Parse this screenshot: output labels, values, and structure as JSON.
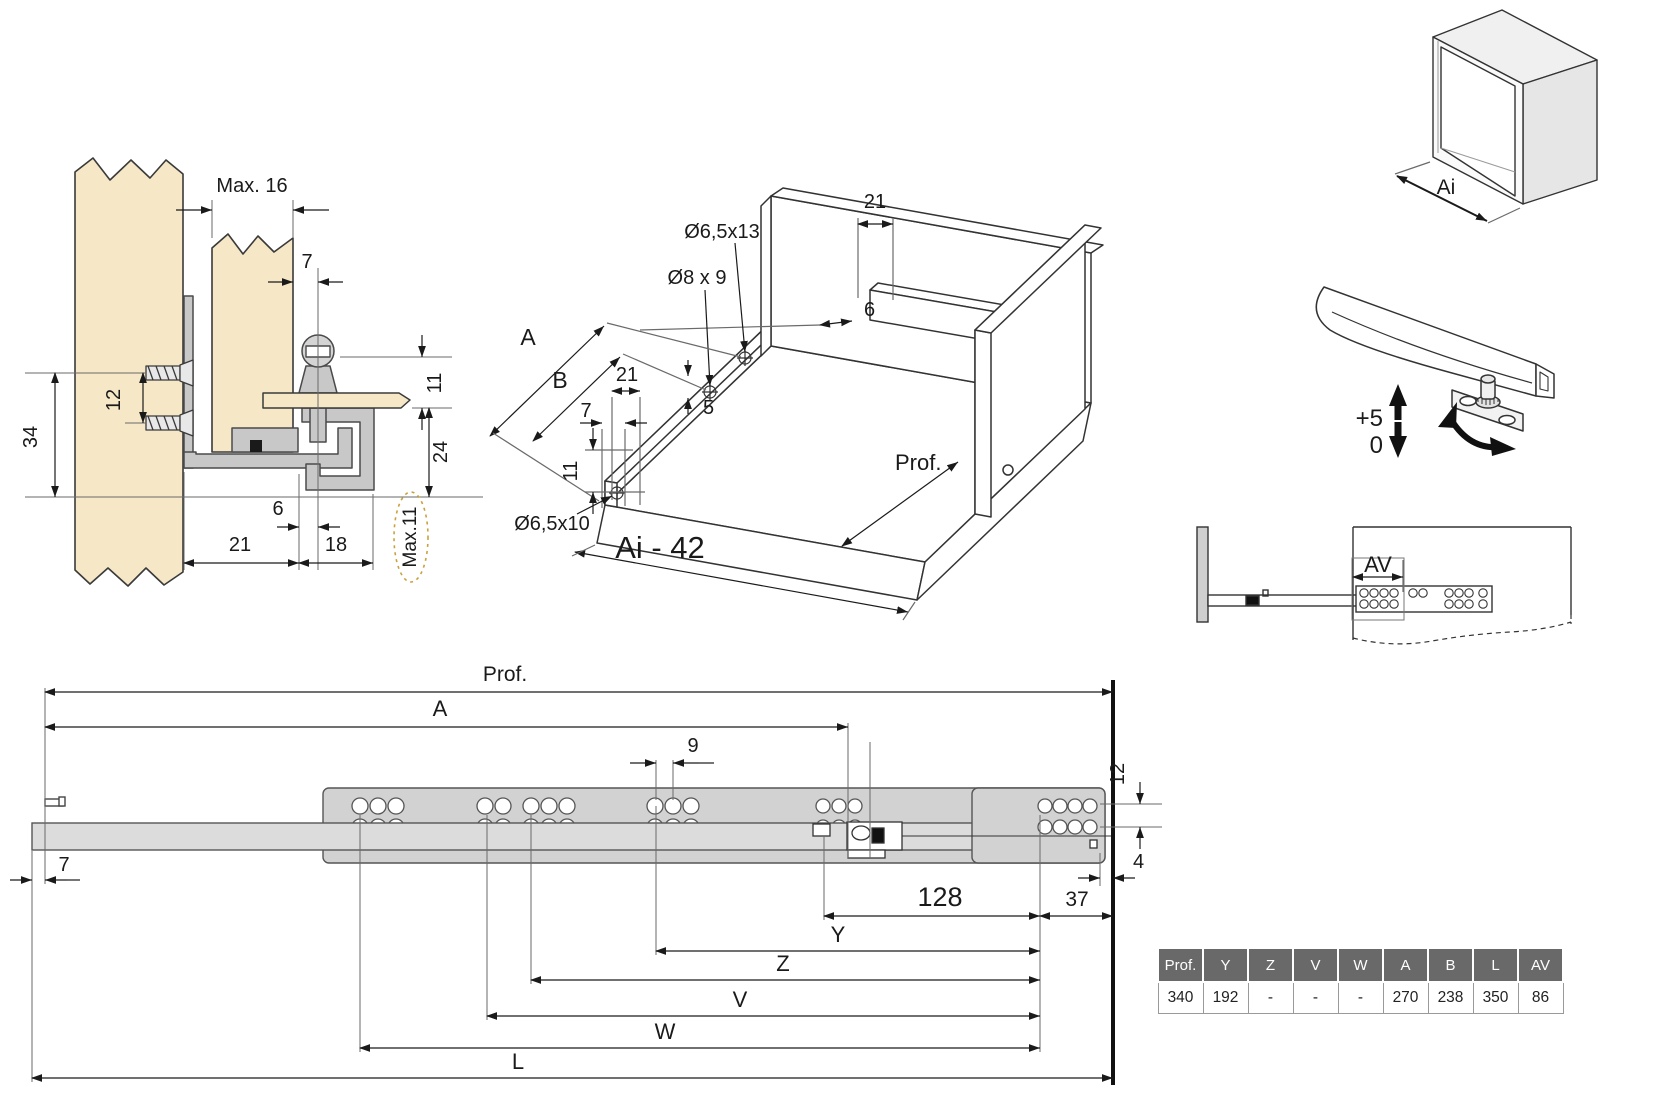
{
  "colors": {
    "wood": "#f6e8c6",
    "metal": "#c8c8c8",
    "metal_light": "#dcdcdc",
    "rail_upper": "#d2d2d2",
    "outline": "#3a3a3a",
    "dimension": "#1a1a1a",
    "highlight_dashed": "#c9a23d",
    "table_header_bg": "#696969",
    "table_header_text": "#ffffff"
  },
  "cross_section": {
    "labels": {
      "max16": "Max. 16",
      "d7": "7",
      "d12": "12",
      "d34": "34",
      "d11": "11",
      "d24": "24",
      "d6": "6",
      "d21": "21",
      "d18": "18",
      "max11": "Max.11"
    }
  },
  "drawer_iso": {
    "labels": {
      "d21_rear": "21",
      "d6": "6",
      "hole_top": "Ø6,5x13",
      "hole_mid": "Ø8 x 9",
      "dim_a": "A",
      "dim_b": "B",
      "d21_front": "21",
      "d7": "7",
      "d5": "5",
      "d11": "11",
      "hole_front": "Ø6,5x10",
      "prof": "Prof.",
      "width_formula": "Ai - 42"
    }
  },
  "cabinet_box": {
    "label_ai": "Ai"
  },
  "height_adjust": {
    "plus": "+5",
    "zero": "0"
  },
  "extension_view": {
    "label_av": "AV"
  },
  "rail_side_view": {
    "labels": {
      "prof": "Prof.",
      "a": "A",
      "d9": "9",
      "d12": "12",
      "d7": "7",
      "d128": "128",
      "d37": "37",
      "d4": "4",
      "y": "Y",
      "z": "Z",
      "v": "V",
      "w": "W",
      "l": "L"
    }
  },
  "spec_table": {
    "headers": [
      "Prof.",
      "Y",
      "Z",
      "V",
      "W",
      "A",
      "B",
      "L",
      "AV"
    ],
    "rows": [
      [
        "340",
        "192",
        "-",
        "-",
        "-",
        "270",
        "238",
        "350",
        "86"
      ]
    ]
  }
}
